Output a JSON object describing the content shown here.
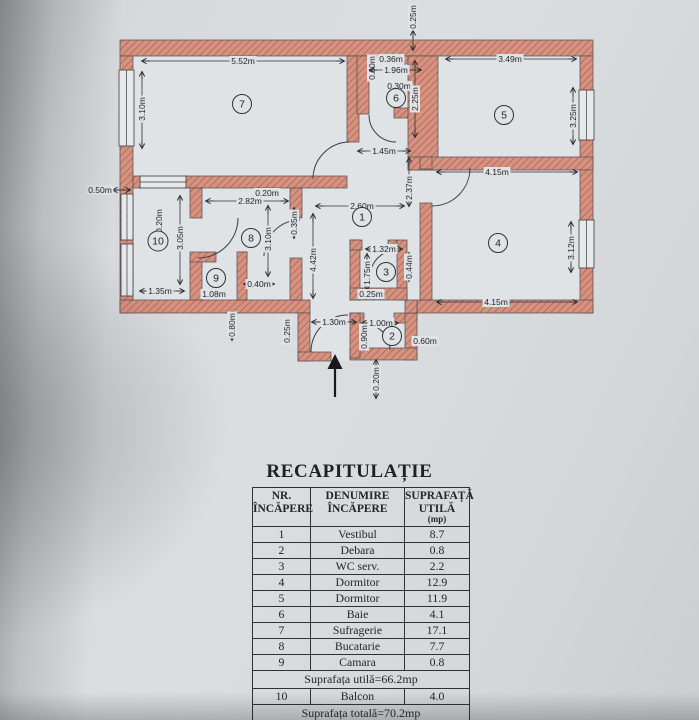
{
  "colors": {
    "wall": "#d69280",
    "wall_hatch": "#ad6150",
    "line": "#3a3d42",
    "paper": "#dadde0"
  },
  "plan": {
    "dims": [
      {
        "t": "0.25m",
        "x": 413,
        "y": 17,
        "r": 1,
        "l": [
          413,
          31,
          413,
          50
        ]
      },
      {
        "t": "5.52m",
        "x": 243,
        "y": 61,
        "r": 0,
        "l": [
          142,
          61,
          344,
          61
        ]
      },
      {
        "t": "3.10m",
        "x": 142,
        "y": 109,
        "r": 1,
        "l": [
          142,
          72,
          142,
          148
        ]
      },
      {
        "t": "0.50m",
        "x": 100,
        "y": 190,
        "r": 0,
        "l": [
          113,
          190,
          130,
          190
        ]
      },
      {
        "t": "0.60m",
        "x": 372,
        "y": 68,
        "r": 1,
        "l": null
      },
      {
        "t": "0.36m",
        "x": 391,
        "y": 59,
        "r": 0,
        "l": null
      },
      {
        "t": "1.96m",
        "x": 396,
        "y": 70,
        "r": 0,
        "l": [
          370,
          70,
          421,
          70
        ]
      },
      {
        "t": "0.30m",
        "x": 399,
        "y": 86,
        "r": 0,
        "l": null
      },
      {
        "t": "2.25m",
        "x": 415,
        "y": 99,
        "r": 1,
        "l": [
          415,
          61,
          415,
          137
        ]
      },
      {
        "t": "3.49m",
        "x": 510,
        "y": 59,
        "r": 0,
        "l": [
          446,
          59,
          576,
          59
        ]
      },
      {
        "t": "3.25m",
        "x": 573,
        "y": 116,
        "r": 1,
        "l": [
          573,
          88,
          573,
          144
        ]
      },
      {
        "t": "1.45m",
        "x": 384,
        "y": 151,
        "r": 0,
        "l": [
          358,
          151,
          410,
          151
        ]
      },
      {
        "t": "2.37m",
        "x": 409,
        "y": 188,
        "r": 1,
        "l": [
          409,
          158,
          409,
          206
        ]
      },
      {
        "t": "4.15m",
        "x": 497,
        "y": 172,
        "r": 0,
        "l": [
          437,
          172,
          577,
          172
        ]
      },
      {
        "t": "2.60m",
        "x": 362,
        "y": 206,
        "r": 0,
        "l": [
          316,
          206,
          404,
          206
        ]
      },
      {
        "t": "0.20m",
        "x": 267,
        "y": 193,
        "r": 0,
        "l": null
      },
      {
        "t": "2.82m",
        "x": 250,
        "y": 201,
        "r": 0,
        "l": [
          206,
          201,
          288,
          201
        ]
      },
      {
        "t": "0.35m",
        "x": 294,
        "y": 223,
        "r": 1,
        "l": [
          294,
          208,
          294,
          238
        ]
      },
      {
        "t": "3.10m",
        "x": 268,
        "y": 239,
        "r": 1,
        "l": [
          268,
          206,
          268,
          276
        ]
      },
      {
        "t": "0.20m",
        "x": 159,
        "y": 221,
        "r": 1,
        "l": null
      },
      {
        "t": "3.05m",
        "x": 180,
        "y": 238,
        "r": 1,
        "l": [
          180,
          196,
          180,
          284
        ]
      },
      {
        "t": "1.35m",
        "x": 160,
        "y": 291,
        "r": 0,
        "l": [
          140,
          291,
          184,
          291
        ]
      },
      {
        "t": "1.08m",
        "x": 214,
        "y": 294,
        "r": 0,
        "l": null
      },
      {
        "t": "0.40m",
        "x": 259,
        "y": 284,
        "r": 0,
        "l": [
          244,
          284,
          274,
          284
        ]
      },
      {
        "t": "0.80m",
        "x": 232,
        "y": 325,
        "r": 1,
        "l": [
          232,
          312,
          232,
          340
        ]
      },
      {
        "t": "4.42m",
        "x": 313,
        "y": 260,
        "r": 1,
        "l": [
          313,
          214,
          313,
          298
        ]
      },
      {
        "t": "1.32m",
        "x": 384,
        "y": 249,
        "r": 0,
        "l": [
          366,
          249,
          402,
          249
        ]
      },
      {
        "t": "1.75m",
        "x": 367,
        "y": 273,
        "r": 1,
        "l": [
          367,
          254,
          367,
          290
        ]
      },
      {
        "t": "0.44m",
        "x": 409,
        "y": 267,
        "r": 1,
        "l": [
          409,
          253,
          409,
          281
        ]
      },
      {
        "t": "0.25m",
        "x": 371,
        "y": 294,
        "r": 0,
        "l": null
      },
      {
        "t": "4.15m",
        "x": 496,
        "y": 302,
        "r": 0,
        "l": [
          437,
          302,
          577,
          302
        ]
      },
      {
        "t": "3.12m",
        "x": 571,
        "y": 248,
        "r": 1,
        "l": [
          571,
          222,
          571,
          272
        ]
      },
      {
        "t": "0.25m",
        "x": 287,
        "y": 331,
        "r": 1,
        "l": null
      },
      {
        "t": "1.30m",
        "x": 334,
        "y": 322,
        "r": 0,
        "l": [
          312,
          322,
          356,
          322
        ]
      },
      {
        "t": "1.00m",
        "x": 381,
        "y": 323,
        "r": 0,
        "l": [
          362,
          323,
          398,
          323
        ]
      },
      {
        "t": "0.90m",
        "x": 364,
        "y": 337,
        "r": 1,
        "l": null
      },
      {
        "t": "0.60m",
        "x": 425,
        "y": 341,
        "r": 0,
        "l": null
      },
      {
        "t": "0.20m",
        "x": 376,
        "y": 379,
        "r": 1,
        "l": [
          376,
          360,
          376,
          398
        ]
      }
    ],
    "rooms": [
      {
        "n": "1",
        "x": 362,
        "y": 217
      },
      {
        "n": "2",
        "x": 392,
        "y": 336
      },
      {
        "n": "3",
        "x": 386,
        "y": 272
      },
      {
        "n": "4",
        "x": 498,
        "y": 243
      },
      {
        "n": "5",
        "x": 504,
        "y": 115
      },
      {
        "n": "6",
        "x": 396,
        "y": 98
      },
      {
        "n": "7",
        "x": 242,
        "y": 104
      },
      {
        "n": "8",
        "x": 251,
        "y": 238
      },
      {
        "n": "9",
        "x": 216,
        "y": 278
      },
      {
        "n": "10",
        "x": 158,
        "y": 241
      }
    ]
  },
  "table": {
    "title": "RECAPITULAȚIE",
    "header": {
      "c1": [
        "NR.",
        "ÎNCĂPERE"
      ],
      "c2": [
        "DENUMIRE",
        "ÎNCĂPERE"
      ],
      "c3": [
        "SUPRAFAȚĂ",
        "UTILĂ",
        "(mp)"
      ]
    },
    "rows": [
      {
        "nr": "1",
        "name": "Vestibul",
        "area": "8.7"
      },
      {
        "nr": "2",
        "name": "Debara",
        "area": "0.8"
      },
      {
        "nr": "3",
        "name": "WC serv.",
        "area": "2.2"
      },
      {
        "nr": "4",
        "name": "Dormitor",
        "area": "12.9"
      },
      {
        "nr": "5",
        "name": "Dormitor",
        "area": "11.9"
      },
      {
        "nr": "6",
        "name": "Baie",
        "area": "4.1"
      },
      {
        "nr": "7",
        "name": "Sufragerie",
        "area": "17.1"
      },
      {
        "nr": "8",
        "name": "Bucatarie",
        "area": "7.7"
      },
      {
        "nr": "9",
        "name": "Camara",
        "area": "0.8"
      }
    ],
    "subtotal": "Suprafața utilă=66.2mp",
    "balcony_row": {
      "nr": "10",
      "name": "Balcon",
      "area": "4.0"
    },
    "total": "Suprafața totală=70.2mp"
  }
}
